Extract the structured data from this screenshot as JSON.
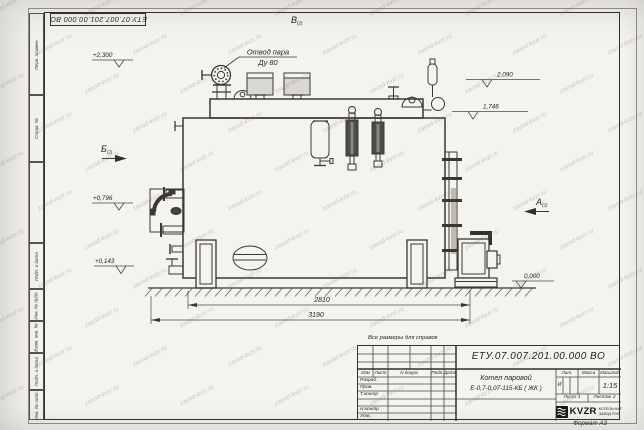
{
  "doc": {
    "number": "ЕТУ.07.007.201.00.000  ВО",
    "note": "Все размеры для справок",
    "format": "Формат А3",
    "watermark": "zavod-kvzr.ru"
  },
  "frame_stamps": [
    "Перв. примен.",
    "Справ. №",
    "Подп. и дата",
    "Инв. № дубл.",
    "Взам. инв. №",
    "Подп. и дата",
    "Инв. № подл."
  ],
  "title_block": {
    "columns": [
      "Изм",
      "Лист",
      "N докум.",
      "Подп.",
      "Дата"
    ],
    "rows": [
      "Разраб.",
      "Пров.",
      "Т.контр",
      "",
      "Н.контр",
      "Утв."
    ],
    "product_line1": "Котел паровой",
    "product_line2": "Е-0,7-0,07-115-КБ ( ЖК )",
    "lit_header": "Лит.",
    "lit_value": "И",
    "mass_header": "Масса",
    "scale_header": "Масштаб",
    "scale_value": "1:15",
    "sheet_label": "Лист",
    "sheet_value": "1",
    "sheets_label": "Листов",
    "sheets_value": "2",
    "company": "KVZR",
    "company_sub1": "КОТЕЛЬНЫЙ",
    "company_sub2": "ЗАВОД РЭП",
    "company_icon": "wave-lines-icon"
  },
  "annotations": {
    "callout_line1": "Отвод пара",
    "callout_line2": "Ду 80",
    "views": [
      {
        "letter": "В",
        "ref": "(2)"
      },
      {
        "letter": "Б",
        "ref": "(2)"
      },
      {
        "letter": "А",
        "ref": "(2)"
      }
    ],
    "elevations": [
      "+2,300",
      "+0,796",
      "+0,143",
      "2,090",
      "1,746",
      "0,000"
    ],
    "dimensions": [
      "2810",
      "3190"
    ]
  }
}
